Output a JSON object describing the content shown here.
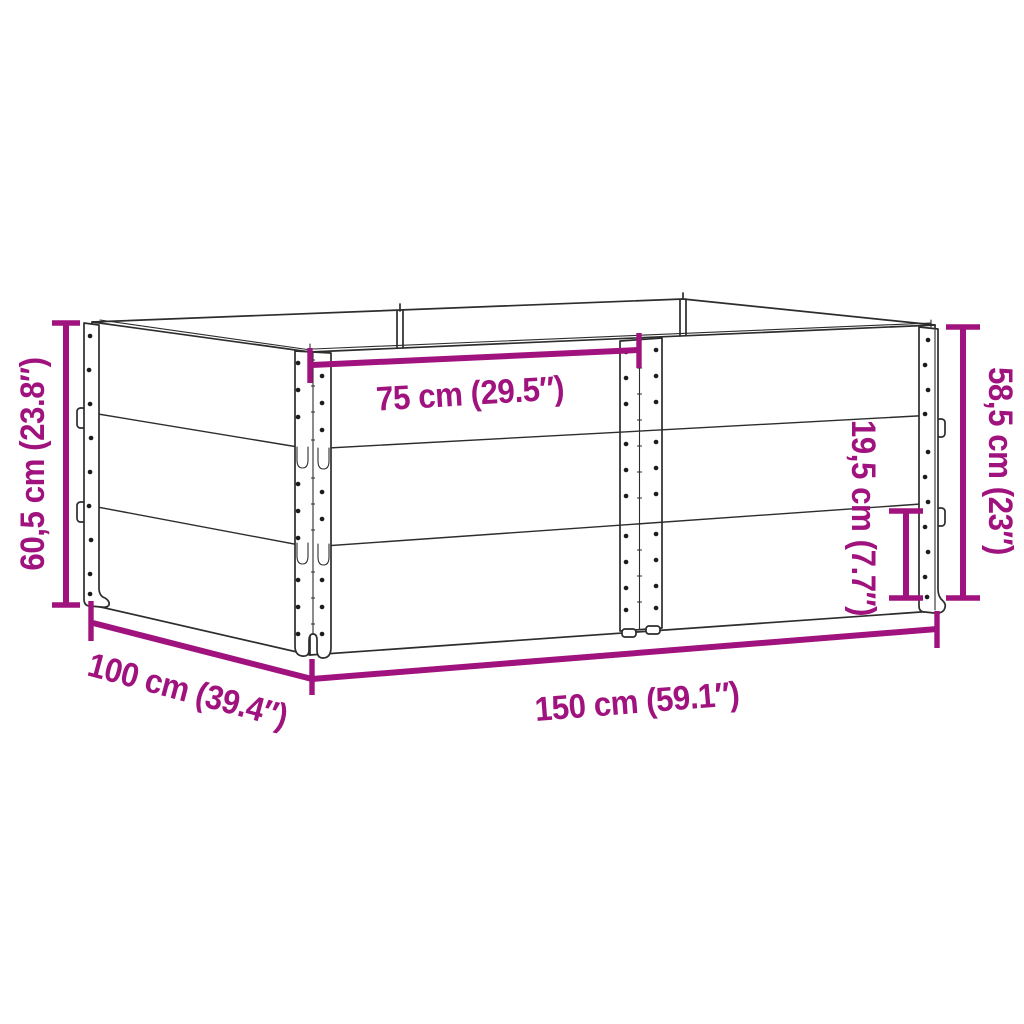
{
  "diagram": {
    "type": "product-dimension-line-drawing",
    "background_color": "#FFFFFF",
    "accent_color": "#A0137E",
    "outline_color": "#2D2D2D",
    "labels": {
      "total_height": "60,5 cm (23.8″)",
      "inner_width": "75 cm (29.5″)",
      "collar_height": "19,5 cm (7.7″)",
      "stack_height": "58,5 cm (23″)",
      "depth": "100 cm (39.4″)",
      "width": "150 cm (59.1″)"
    }
  }
}
